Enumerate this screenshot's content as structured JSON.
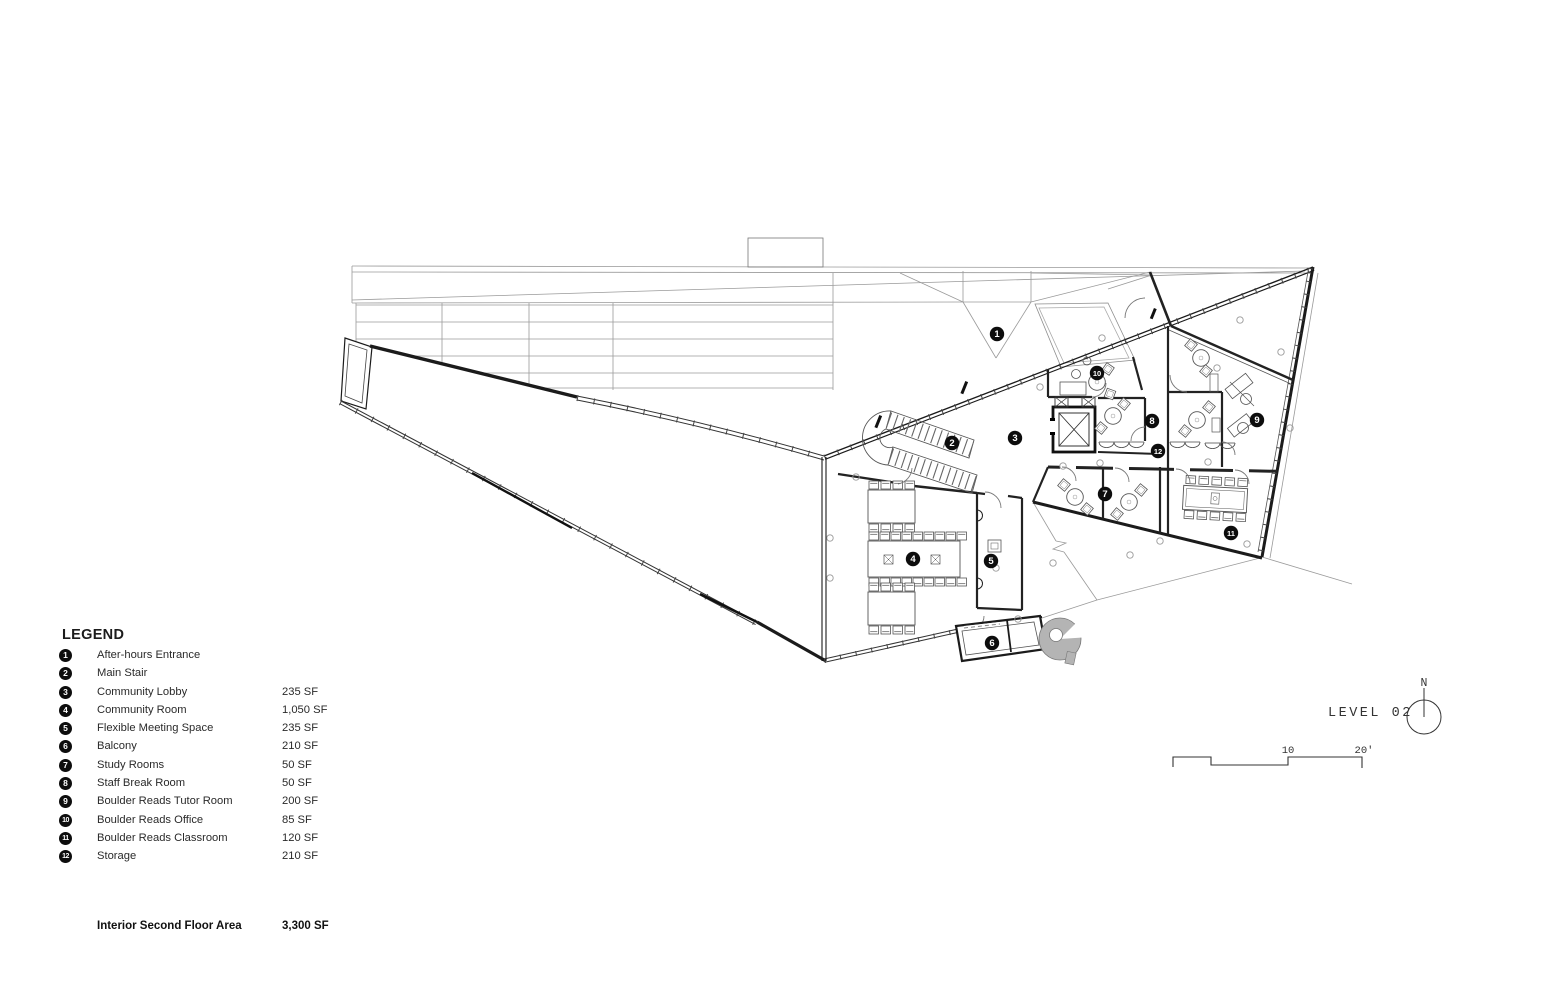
{
  "drawing": {
    "title": "LEVEL 02",
    "north_label": "N",
    "scale_tick_mid": "10",
    "scale_tick_end": "20'"
  },
  "legend": {
    "title": "LEGEND",
    "items": [
      {
        "num": "1",
        "label": "After-hours Entrance",
        "area": ""
      },
      {
        "num": "2",
        "label": "Main Stair",
        "area": ""
      },
      {
        "num": "3",
        "label": "Community Lobby",
        "area": "235 SF"
      },
      {
        "num": "4",
        "label": "Community Room",
        "area": "1,050 SF"
      },
      {
        "num": "5",
        "label": "Flexible Meeting Space",
        "area": "235 SF"
      },
      {
        "num": "6",
        "label": "Balcony",
        "area": "210 SF"
      },
      {
        "num": "7",
        "label": "Study Rooms",
        "area": "50 SF"
      },
      {
        "num": "8",
        "label": "Staff Break Room",
        "area": "50 SF"
      },
      {
        "num": "9",
        "label": "Boulder Reads Tutor Room",
        "area": "200 SF"
      },
      {
        "num": "10",
        "label": "Boulder Reads Office",
        "area": "85 SF"
      },
      {
        "num": "11",
        "label": "Boulder Reads Classroom",
        "area": "120 SF"
      },
      {
        "num": "12",
        "label": "Storage",
        "area": "210 SF"
      }
    ],
    "total_label": "Interior Second Floor Area",
    "total_area": "3,300 SF"
  },
  "plan_markers": [
    {
      "num": "1",
      "x": 997,
      "y": 334
    },
    {
      "num": "2",
      "x": 952,
      "y": 443
    },
    {
      "num": "3",
      "x": 1015,
      "y": 438
    },
    {
      "num": "4",
      "x": 913,
      "y": 559
    },
    {
      "num": "5",
      "x": 991,
      "y": 561
    },
    {
      "num": "6",
      "x": 992,
      "y": 643
    },
    {
      "num": "7",
      "x": 1105,
      "y": 494
    },
    {
      "num": "8",
      "x": 1152,
      "y": 421
    },
    {
      "num": "9",
      "x": 1257,
      "y": 420
    },
    {
      "num": "10",
      "x": 1097,
      "y": 373
    },
    {
      "num": "11",
      "x": 1231,
      "y": 533
    },
    {
      "num": "12",
      "x": 1158,
      "y": 451
    }
  ]
}
